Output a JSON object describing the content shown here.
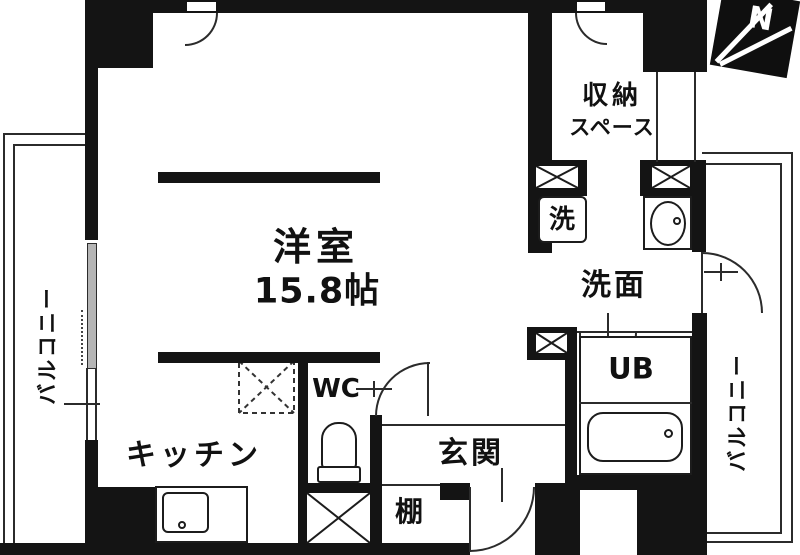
{
  "rooms": {
    "main_room": {
      "label": "洋室",
      "area": "15.8帖"
    },
    "storage": {
      "label_line1": "収納",
      "label_line2": "スペース"
    },
    "laundry": {
      "label": "洗"
    },
    "washroom": {
      "label": "洗面"
    },
    "unit_bath": {
      "label": "UB"
    },
    "entrance": {
      "label": "玄関"
    },
    "shelf": {
      "label": "棚"
    },
    "kitchen": {
      "label": "キッチン"
    },
    "toilet": {
      "label": "WC"
    },
    "balcony_left": {
      "label": "バルコニー"
    },
    "balcony_right": {
      "label": "バルコニー"
    }
  },
  "compass": {
    "label": "N"
  },
  "colors": {
    "wall": "#141414",
    "line": "#2b2b2b",
    "window_pane": "#b5b5b5",
    "background": "#ffffff"
  }
}
